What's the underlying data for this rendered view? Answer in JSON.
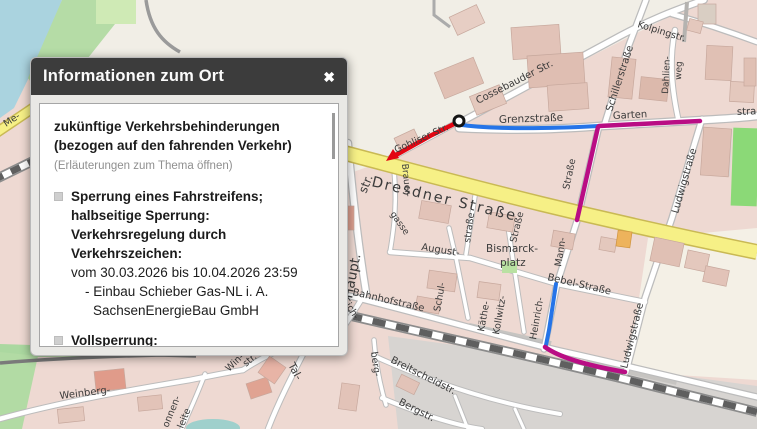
{
  "popup": {
    "title": "Informationen zum Ort",
    "close_label": "✖",
    "intro_line1": "zukünftige Verkehrsbehinderungen",
    "intro_line2": "(bezogen auf den fahrenden Verkehr)",
    "hint": "(Erläuterungen zum Thema öffnen)",
    "items": [
      {
        "heading": "Sperrung eines Fahrstreifens; halbseitige Sperrung: Verkehrsregelung durch Verkehrszeichen:",
        "period": "vom 30.03.2026 bis 10.04.2026 23:59",
        "detail_line1": "- Einbau Schieber Gas-NL i. A.",
        "detail_line2": "SachsenEnergieBau GmbH"
      },
      {
        "heading": "Vollsperrung:",
        "period": "vom 13.04.2026 bis 29.04.2026 23:59"
      }
    ]
  },
  "map": {
    "colors": {
      "route_red": "#e30613",
      "route_blue": "#2574e8",
      "route_magenta": "#b90d84",
      "road_yellow": "#f6f086",
      "road_yellow_casing": "#c9b954",
      "water": "#aad3df"
    },
    "labels": [
      "Cossebauder Str.",
      "Grenzstraße",
      "Kolpingstr.",
      "Schillerstraße",
      "Dahlien-",
      "weg",
      "Garten",
      "stra",
      "Straße",
      "Mann-",
      "Ludwigstraße",
      "Ludwigstraße",
      "Bebel-Straße",
      "Heinrich-",
      "Dresdner Straße",
      "Gohliser Str.",
      "str.",
      "Brauer-",
      "gasse",
      "Haupt.",
      "August-",
      "Bismarck-",
      "platz",
      "Schul-",
      "Käthe-",
      "Kollwitz-",
      "Straße",
      "straße",
      "Bahnhofstraße",
      "Eich-",
      "berg-",
      "Breitscheidstr.",
      "Bergstr.",
      "Weinberg-",
      "onnen-",
      "leite",
      "Win-",
      "str.",
      "Tal-",
      "Me-",
      "tr."
    ]
  }
}
